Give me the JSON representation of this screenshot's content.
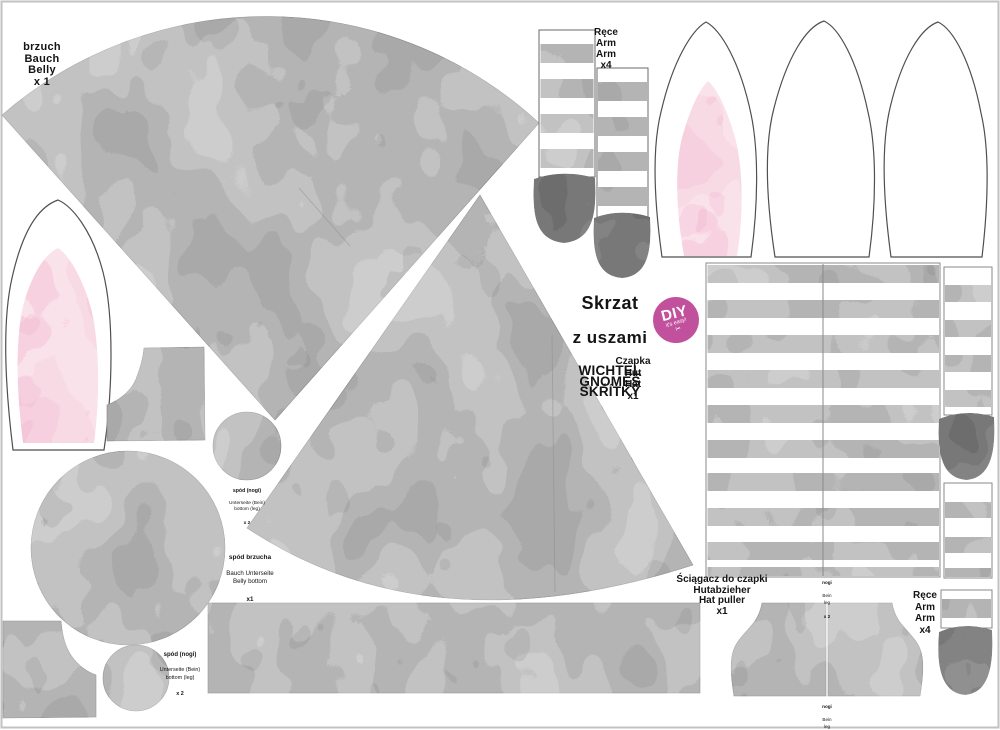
{
  "sheet_title": {
    "main_line1": "Skrzat",
    "main_line2": "z uszami",
    "translations": "WICHTEL\nGNOMES\nSKŘÍTKY"
  },
  "badge": {
    "main": "DIY",
    "tagline": "it's easy!",
    "icon": "scissors",
    "icon_glyph": "✂",
    "color": "#c2519d"
  },
  "labels": {
    "belly": "brzuch\nBauch\nBelly\nx 1",
    "arms": "Ręce\nArm\nArm\nx4",
    "hat": "Czapka\nHut\nHat\nx1",
    "leg_bottom": {
      "title": "spód (nogi)",
      "rest": "Unterseite (Bein)\nbottom (leg)",
      "count": "x 2"
    },
    "belly_bottom": {
      "title": "spód brzucha",
      "rest": "Bauch Unterseite\nBelly bottom",
      "count": "x1"
    },
    "hat_puller": "Ściągacz do czapki\nHutabzieher\nHat puller\nx1",
    "legs": {
      "title": "nogi",
      "rest": "Bein\nleg",
      "count": "x 2"
    }
  },
  "colors": {
    "fabric_gray": "#a9a9a9",
    "fabric_dark": "#6d6d6d",
    "fabric_pink": "#f5c6d7",
    "badge_pink": "#c2519d",
    "outline_gray": "#555555",
    "frame_border": "#c2c2c2"
  }
}
